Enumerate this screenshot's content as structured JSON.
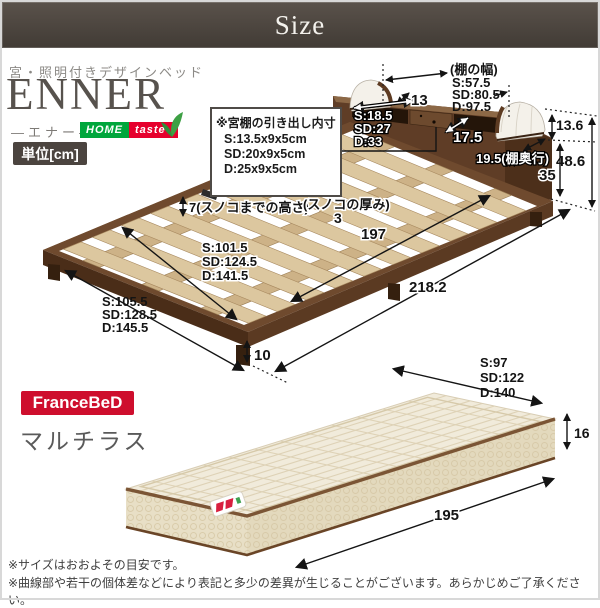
{
  "header": {
    "title": "Size"
  },
  "brand": {
    "subtitle": "宮・照明付きデザインベッド",
    "name": "ENNER",
    "reading": "—エナー—",
    "logo_home": "HOME",
    "logo_taste": "taste",
    "unit": "単位[cm]"
  },
  "bed": {
    "shelf_width_caption": "(棚の幅)",
    "shelf_width_s": "S:57.5",
    "shelf_width_sd": "SD:80.5",
    "shelf_width_d": "D:97.5",
    "lamp_width": "13",
    "drawer_box_title": "※宮棚の引き出し内寸",
    "drawer_box_s": "S:13.5x9x5cm",
    "drawer_box_sd": "SD:20x9x5cm",
    "drawer_box_d": "D:25x9x5cm",
    "shelf_inner_s": "S:18.5",
    "shelf_inner_sd": "SD:27",
    "shelf_inner_d": "D:33",
    "shelf_front_depth": "17.5",
    "lamp_height": "13.6",
    "shelf_depth": "19.5(棚奥行)",
    "headboard_total_height": "48.6",
    "headboard_body_height": "35",
    "slat_clearance": "7(スノコまでの高さ)",
    "slat_thickness_caption": "(スノコの厚み)",
    "slat_thickness": "3",
    "slat_area_length": "197",
    "inner_width_s": "S:101.5",
    "inner_width_sd": "SD:124.5",
    "inner_width_d": "D:141.5",
    "total_length": "218.2",
    "outer_width_s": "S:105.5",
    "outer_width_sd": "SD:128.5",
    "outer_width_d": "D:145.5",
    "leg_height": "10"
  },
  "mattress": {
    "brand": "FranceBeD",
    "series": "マルチラス",
    "width_s": "S:97",
    "width_sd": "SD:122",
    "width_d": "D:140",
    "height": "16",
    "length": "195"
  },
  "notes": {
    "line1": "※サイズはおおよその目安です。",
    "line2": "※曲線部や若干の個体差などにより表記と多少の差異が生じることがございます。あらかじめご了承ください。"
  },
  "colors": {
    "header_bg": "#474038",
    "wood_dark": "#5a3a24",
    "slat": "#dcc79f",
    "brand_green": "#00a63c",
    "brand_red": "#e6002d",
    "francebed_red": "#ce0e2d",
    "mattress_cream": "#f1ebdb",
    "piping_brown": "#7b5535"
  }
}
